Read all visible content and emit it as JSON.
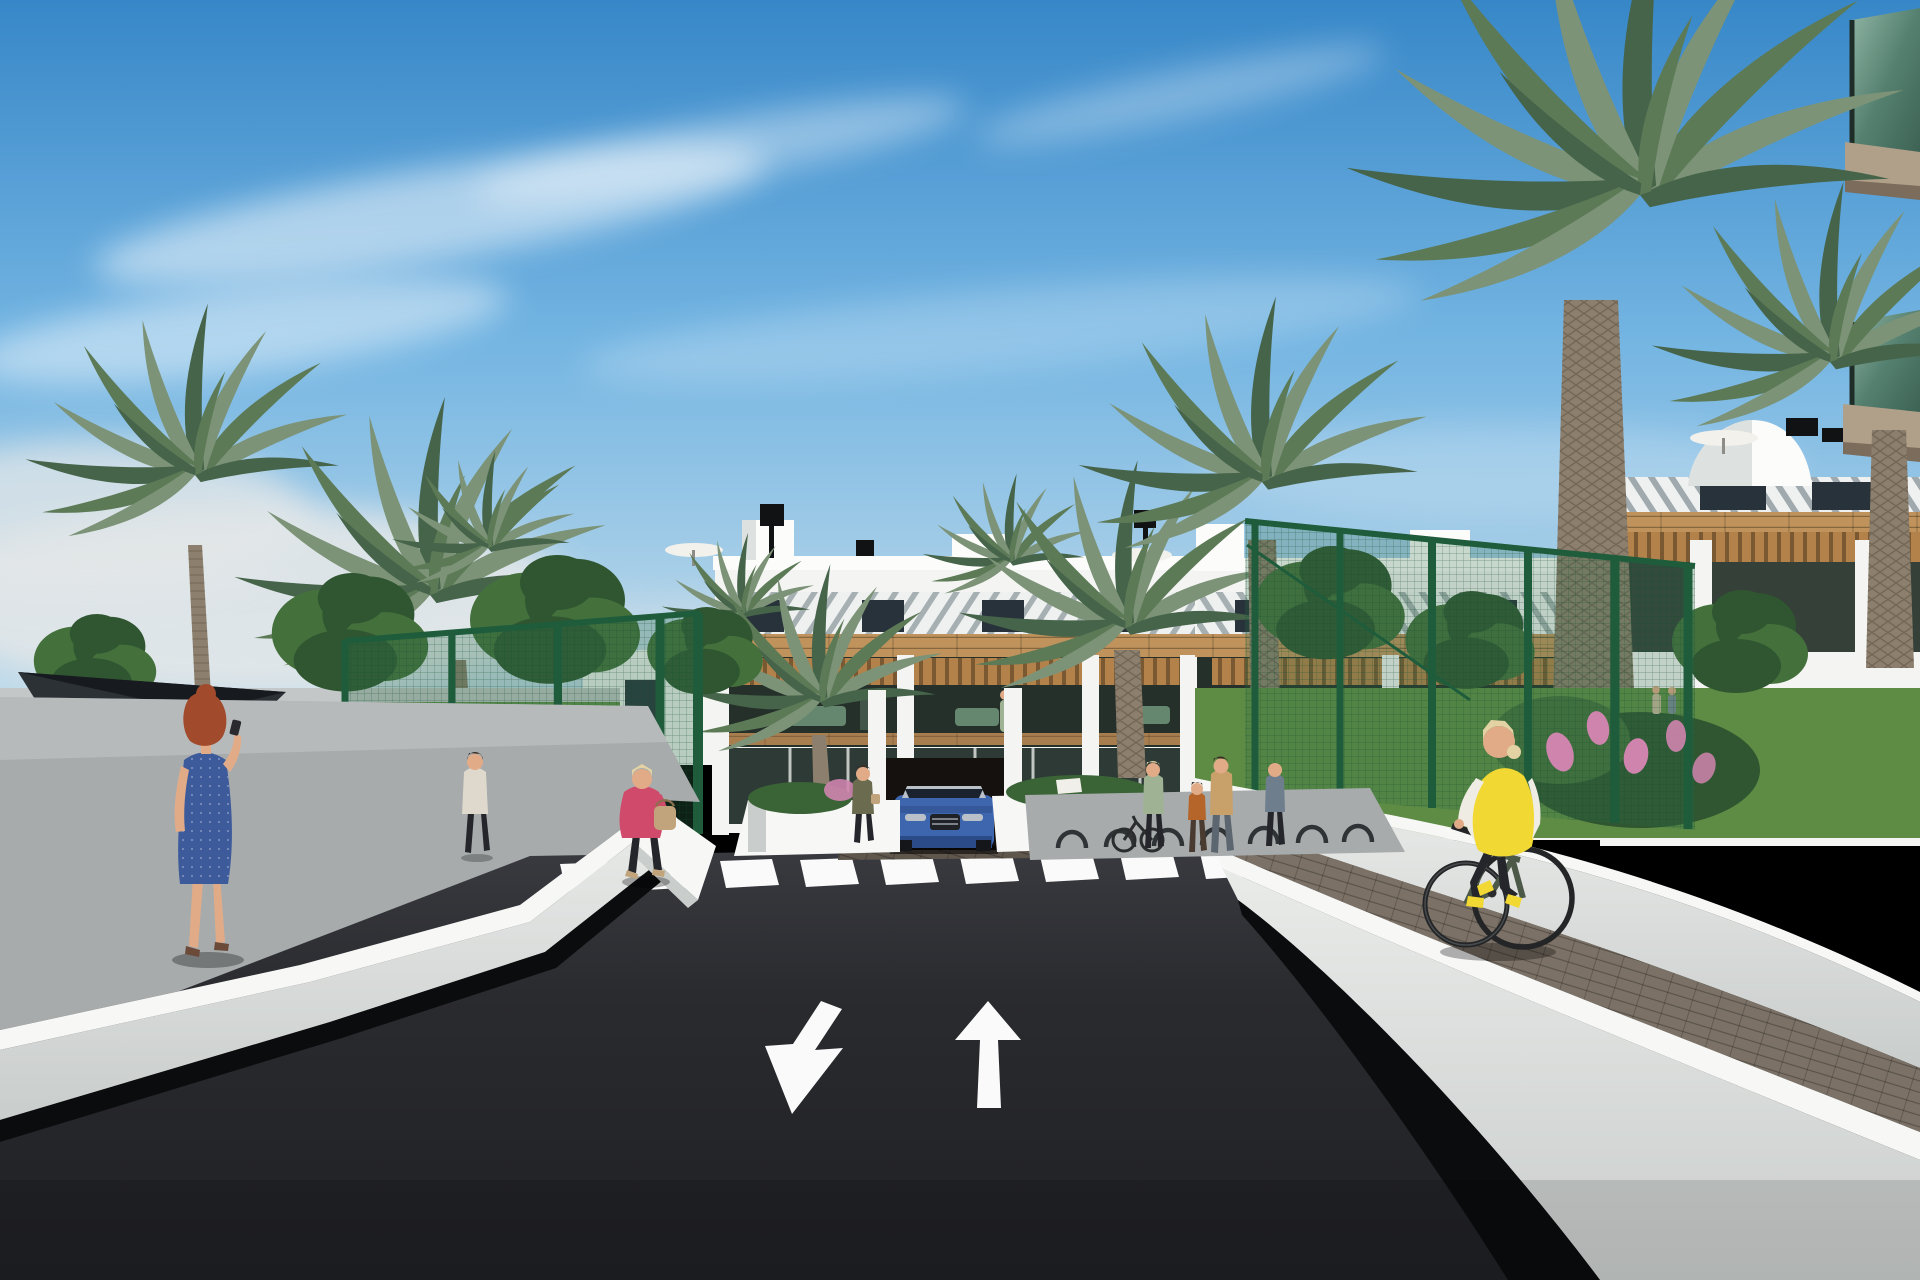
{
  "scene": {
    "type": "architectural-render-exterior",
    "objects": [
      "sky",
      "clouds",
      "horizon-haze",
      "apartment-building-center",
      "apartment-building-right",
      "rooftop-parasols",
      "rooftop-chimneys",
      "rooftop-dome",
      "foreground-corner-building-glass-balconies",
      "palm-trees",
      "fan-palm",
      "leafy-trees",
      "garden-bushes",
      "pink-flowers",
      "orange-flowers",
      "shade-sail",
      "padel-court-fence-left",
      "garden-fence-right",
      "left-sidewalk",
      "left-retaining-wall",
      "right-retaining-wall",
      "right-paver-path",
      "asphalt-road",
      "zebra-crosswalk",
      "lane-arrow-toward-viewer",
      "lane-arrow-away",
      "small-ramp-arrows",
      "blue-suv",
      "garage-entrance",
      "entrance-planters",
      "planter-sign",
      "bike-racks",
      "parked-bicycle",
      "pedestrian-woman-blue-dress",
      "pedestrian-man-distant",
      "pedestrian-woman-pink-jacket",
      "pedestrian-woman-entrance",
      "balcony-resident",
      "pedestrian-group-right",
      "distant-couple",
      "cyclist-yellow-vest"
    ],
    "counts": {
      "lane_arrows": 2,
      "crosswalk_stripes": 11,
      "vehicles": 1,
      "cyclists": 1
    }
  },
  "road": {
    "marking_color": "#fafafa",
    "arrow_directions": [
      "toward-viewer",
      "away-from-viewer"
    ],
    "crosswalk_stripes": 11
  },
  "palette": {
    "sky_top": "#3787c8",
    "sky_mid": "#74b5e2",
    "sky_low": "#cfe2ec",
    "cloud_white": "#ffffff",
    "haze_white": "#e3e7e8",
    "bldg_white": "#f4f5f3",
    "bldg_bright": "#fcfcfa",
    "bldg_shade": "#dde1df",
    "louver_base": "#eef1f0",
    "louver_stripe": "#55666e",
    "window_dark": "#27323a",
    "wood": "#c0935c",
    "wood_dark": "#9c7340",
    "pergola_wood": "#b2824a",
    "interior_dark": "#243029",
    "glass_dark": "#2e3a36",
    "floor_wood": "#a97e4e",
    "fascia_tan": "#b1a089",
    "fascia_dark": "#7c6c5c",
    "balcony_glass_a": "#55806f",
    "balcony_glass_b": "#8fb4a4",
    "palm_a": "#7c9377",
    "palm_b": "#5d7a57",
    "palm_c": "#46644a",
    "trunk": "#8c7f6d",
    "trunk_dark": "#625648",
    "tree_a": "#44703c",
    "tree_b": "#2f5630",
    "hedge": "#3a6336",
    "grass": "#5e8c44",
    "fence_green": "#1e5c3b",
    "mesh_green": "#2e6d49",
    "sail_dark": "#2c3136",
    "path_gray": "#a7abac",
    "path_light": "#c3c7c8",
    "asphalt": "#1f2024",
    "asphalt_top": "#3a3b40",
    "marking": "#fafafa",
    "wall_top": "#f7f8f6",
    "wall_face": "#e9ebe9",
    "wall_face2": "#c9cdcb",
    "shadow_dark": "#0b0c0e",
    "paver": "#7b7166",
    "paver_dark": "#5f564c",
    "car_blue": "#3e66ae",
    "car_blue_dark": "#2b4a88",
    "car_glass": "#1a222e",
    "chrome": "#b9c0c8",
    "tire": "#141619",
    "flower_pink": "#cf84ae",
    "flower_orange": "#cd8a45",
    "skin": "#e2ab87",
    "hair_red": "#a14a2c",
    "hair_blonde": "#e3d3a4",
    "hair_dark": "#3a2e26",
    "dress_blue": "#3d5a9b",
    "jacket_pink": "#cf4a6b",
    "bag_tan": "#c2a47c",
    "shirt_light": "#ded9cc",
    "pants_dark": "#25262b",
    "vest_yellow": "#f2d832",
    "sleeve_white": "#efece3",
    "bike_frame": "#4c5949",
    "top_olive": "#6b6b4f",
    "top_tan": "#c8a06a",
    "top_sage": "#9fb394",
    "top_slate": "#6e7e8c",
    "shadow_soft": "#1a1b1d"
  }
}
